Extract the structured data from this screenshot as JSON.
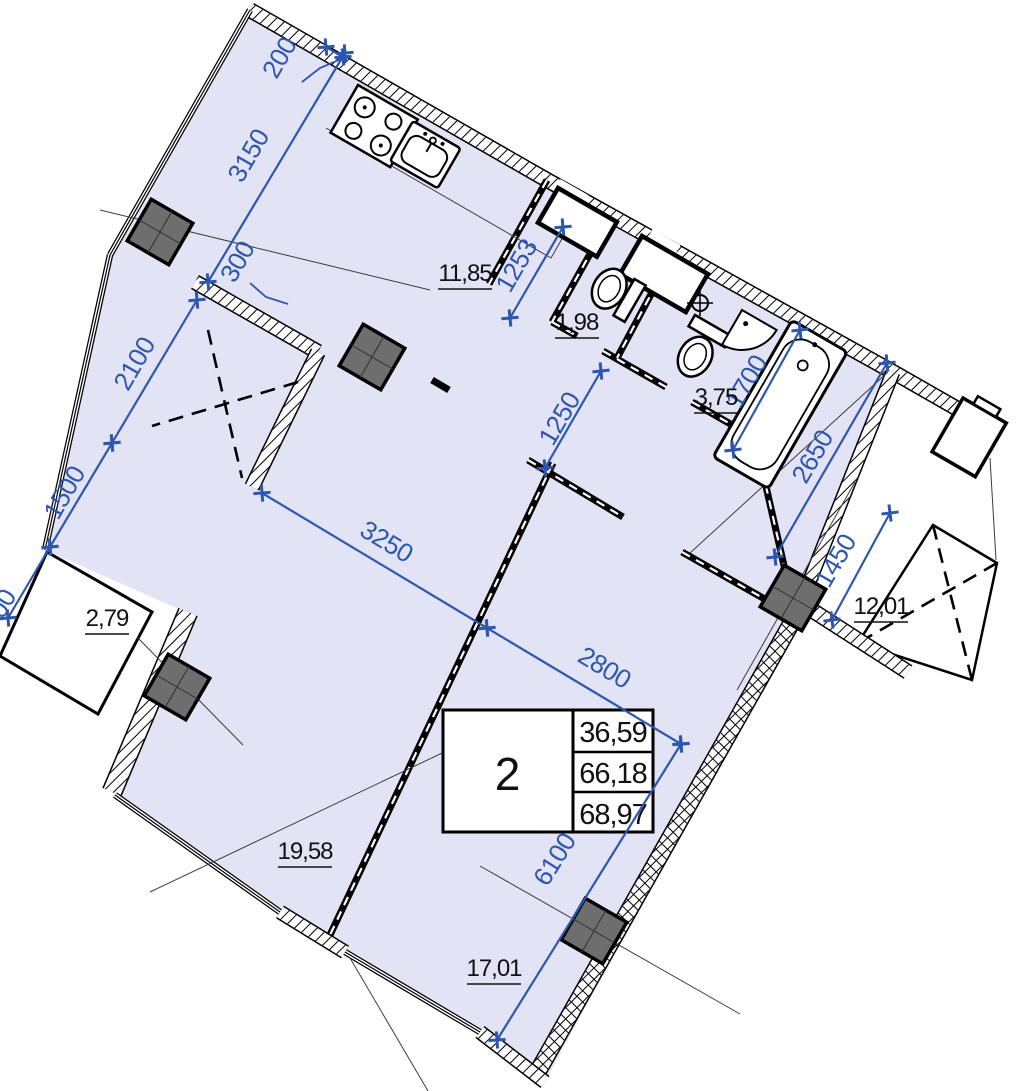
{
  "table": {
    "apartment_number": "2",
    "rows": [
      "36,59",
      "66,18",
      "68,97"
    ]
  },
  "areas": {
    "kitchen": "11,85",
    "wc": "1,98",
    "bathroom": "3,75",
    "left_balcony": "2,79",
    "right_balcony": "12,01",
    "room_large": "19,58",
    "room_second": "17,01"
  },
  "dims": {
    "d200": "200",
    "d300": "300",
    "d3150": "3150",
    "d2100": "2100",
    "d1500": "1500",
    "d00": "00",
    "d1253": "1253",
    "d1250": "1250",
    "d1700": "1700",
    "d2650": "2650",
    "d1450": "1450",
    "d3250": "3250",
    "d2800": "2800",
    "d6100": "6100"
  },
  "colors": {
    "floor_fill": "#e2e3f5",
    "dimension_blue": "#2d57ae",
    "wall_black": "#000000",
    "column_gray": "#6e6e6e"
  }
}
